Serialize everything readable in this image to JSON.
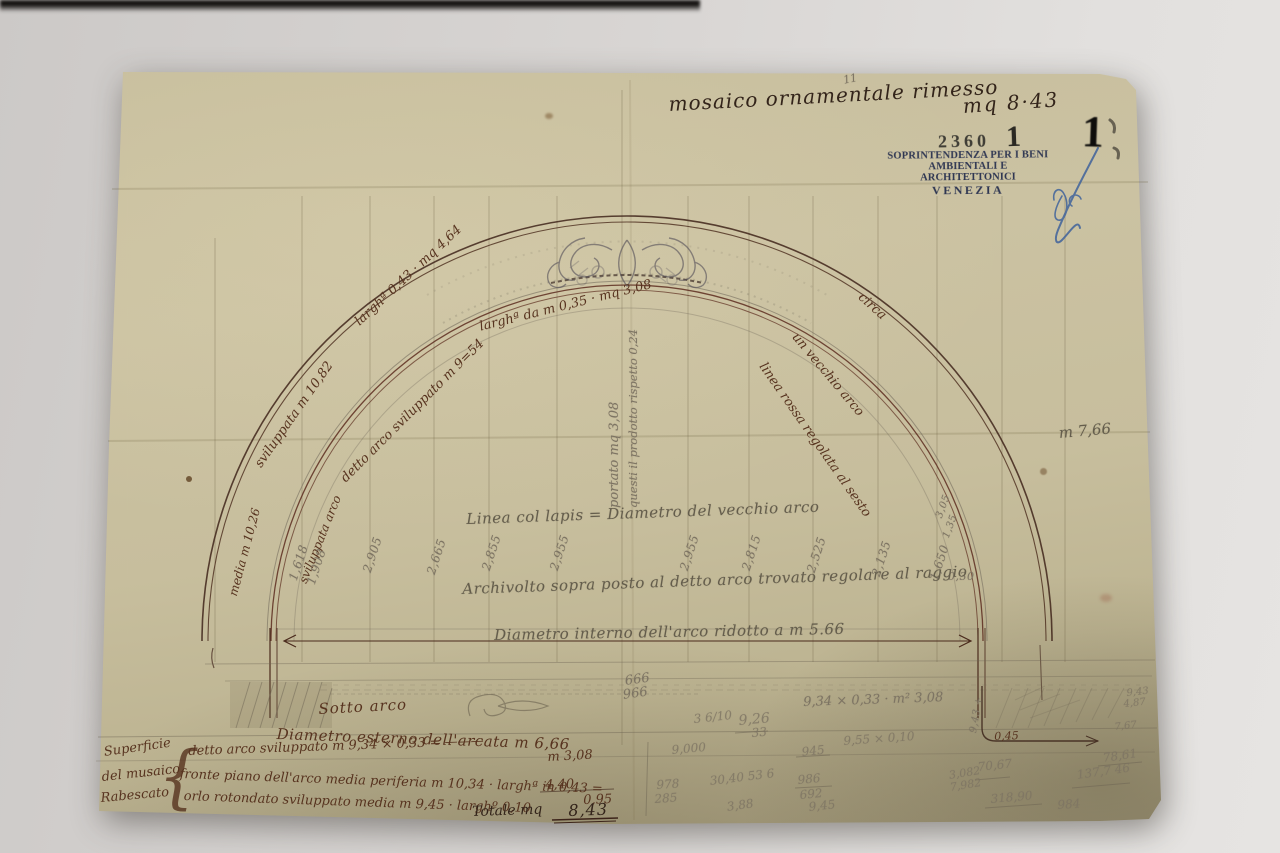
{
  "photo": {
    "backdrop": "#d8d5d3",
    "paper": "#c9c09e"
  },
  "header_note": {
    "text": "mosaico ornamentale rimesso",
    "value": "mq 8·43",
    "tick": "11"
  },
  "stamps": {
    "protocol": "2360",
    "protocol_digit": "1",
    "office_line1": "SOPRINTENDENZA PER I BENI",
    "office_line2": "AMBIENTALI E ARCHITETTONICI",
    "office_line3": "VENEZIA",
    "corner_digit": "1"
  },
  "side_note": "m 7,66",
  "arc_labels": [
    {
      "text": "sviluppata m 10,82"
    },
    {
      "text": "larghª 0,43 · mq 4,64"
    },
    {
      "text": "media m 10,26"
    },
    {
      "text": "sviluppata arco"
    },
    {
      "text": "detto arco sviluppato m 9=54"
    },
    {
      "text": "larghª da m 0,35 · mq 3,08"
    },
    {
      "text": "circa"
    },
    {
      "text": "un vecchio arco"
    },
    {
      "text": "linea rossa regolata al sesto"
    }
  ],
  "vertical_numbers": [
    "1,618",
    "1,908",
    "2,905",
    "2,665",
    "2,855",
    "2,955",
    "2,955",
    "2,815",
    "2,525",
    "2,135",
    "1,650",
    "3,05",
    "1,35",
    "0,30",
    "9,43 +"
  ],
  "center_notes": {
    "lapis": "Linea col lapis = Diametro del vecchio arco",
    "archivolto": "Archivolto sopra posto al detto arco trovato regolare al raggio",
    "diametro_interno": "Diametro interno dell'arco ridotto a m 5.66",
    "col_a": "portato mq 3,08",
    "col_b": "questi il prodotto rispetto 0,24"
  },
  "bottom_notes": {
    "stack_top": "666",
    "stack_bottom": "966",
    "sotto_arco": "Sotto arco",
    "mult": "9,34 × 0,33 · m² 3,08",
    "diametro_esterno": "Diametro esterno dell'arcata m 6,66",
    "margin_1": "Superficie",
    "margin_2": "del musaico",
    "margin_3": "Rabescato",
    "brace": "{",
    "rows": [
      {
        "text": "detto arco sviluppato m 9,34 × 0,33 = ———",
        "result": "m 3,08"
      },
      {
        "text": "fronte piano dell'arco media periferia m 10,34 · larghª in 0,43 =",
        "result": "4,40"
      },
      {
        "text": "orlo rotondato sviluppato media m 9,45 · larghº 0,10",
        "result": "0,95"
      }
    ],
    "total_label": "Totale mq",
    "total_value": "8,43",
    "corner_value": "0,45"
  },
  "scribbles": [
    "3 6/10",
    "9,26",
    "33",
    "9,000",
    "945",
    "9,55 × 0,10",
    "978",
    "285",
    "30,40 53 6",
    "3,88",
    "986",
    "692",
    "9,45",
    "9,43",
    "4,87",
    "7,67",
    "70,67",
    "78,61",
    "137,7 46",
    "3,082",
    "7,982",
    "318,90",
    "984"
  ]
}
